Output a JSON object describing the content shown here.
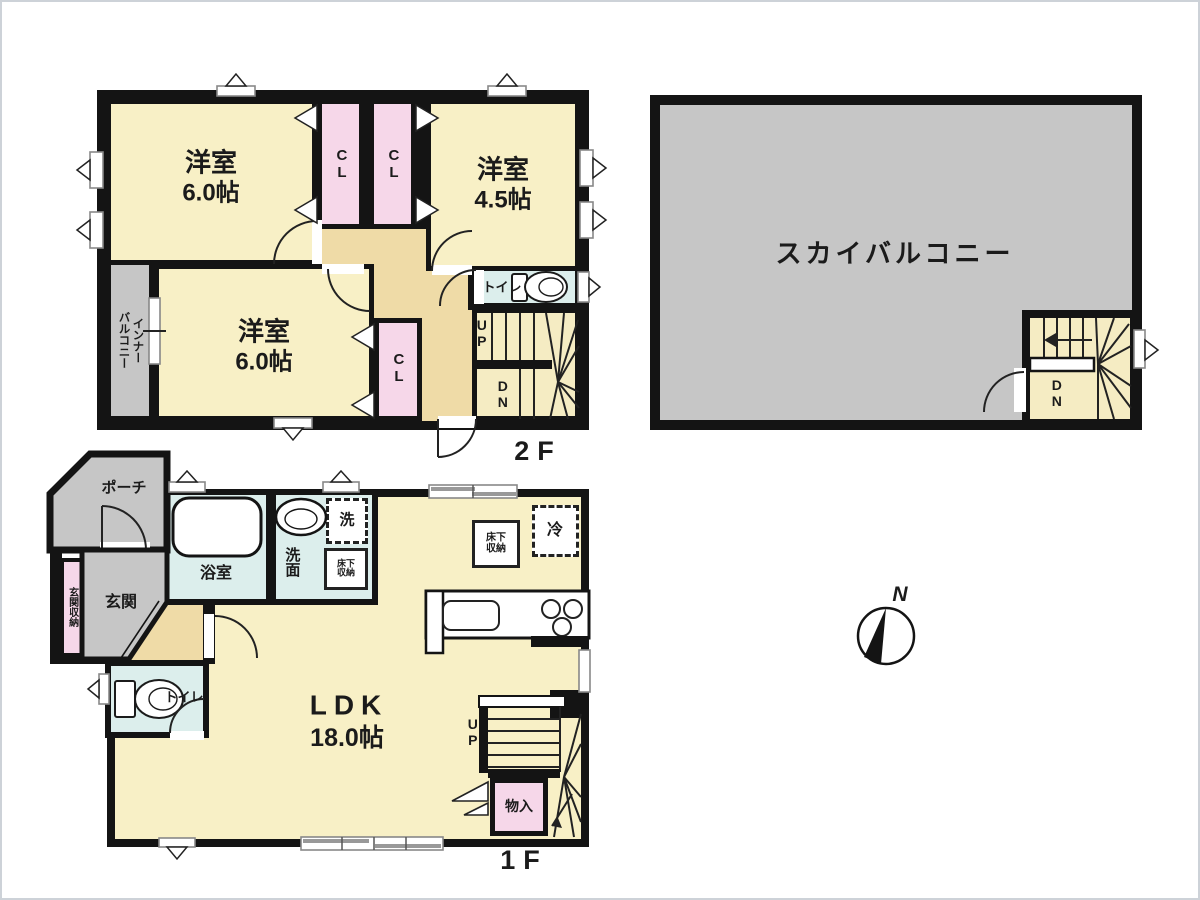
{
  "page": {
    "floor2_label": "2F",
    "floor1_label": "1F"
  },
  "floor2": {
    "rooms": [
      {
        "name": "洋室",
        "size": "6.0帖"
      },
      {
        "name": "洋室",
        "size": "4.5帖"
      },
      {
        "name": "洋室",
        "size": "6.0帖"
      }
    ],
    "closet": "CL",
    "toilet": "トイレ",
    "inner_balcony_lines": [
      "インナー",
      "バルコニー"
    ],
    "stairs": {
      "up": "UP",
      "down": "DN"
    }
  },
  "sky_balcony": {
    "name": "スカイバルコニー",
    "stairs_down": "DN"
  },
  "floor1": {
    "porch": "ポーチ",
    "entrance": "玄関",
    "entrance_storage": "玄関収納",
    "bathroom": "浴室",
    "washroom": "洗面",
    "washer": "洗",
    "underfloor_storage_lines": [
      "床下",
      "収納"
    ],
    "fridge": "冷",
    "ldk": {
      "name": "LDK",
      "size": "18.0帖"
    },
    "toilet": "トイレ",
    "storage": "物入",
    "stairs_up": "UP"
  },
  "compass": {
    "north": "N"
  },
  "colors": {
    "wall": "#141414",
    "room": "#F8F0C6",
    "hall": "#EFDBA7",
    "closet": "#F6D7E9",
    "wet": "#DCEEEC",
    "outdoor": "#C6C6C6"
  }
}
